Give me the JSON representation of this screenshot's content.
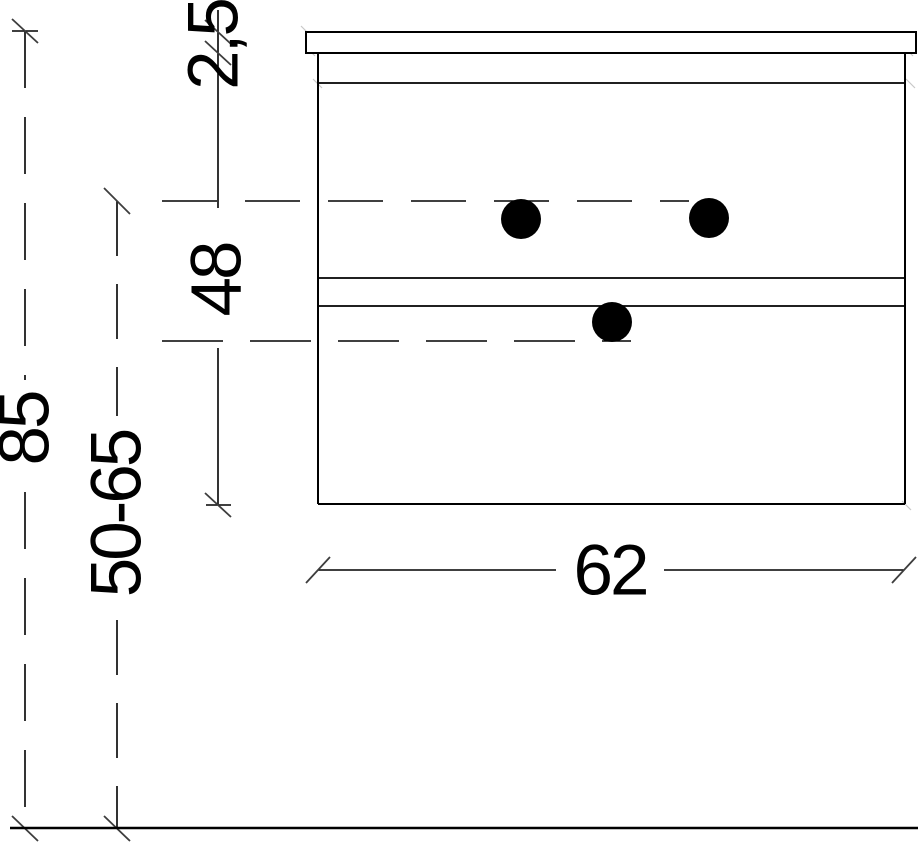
{
  "diagram": {
    "subject": "vanity-cabinet-front-elevation-dimension-drawing",
    "dimension_labels": {
      "overall_height": "85",
      "installation_height_range": "50-65",
      "top_thickness": "2,5",
      "body_height": "48",
      "width": "62"
    },
    "knob_count": 3,
    "drawer_divider_lines": 2,
    "colors": {
      "background": "#ffffff",
      "line": "#000000",
      "tick": "#3d3d3d",
      "knob": "#000000",
      "faint_mark": "#c9c9c9"
    }
  }
}
